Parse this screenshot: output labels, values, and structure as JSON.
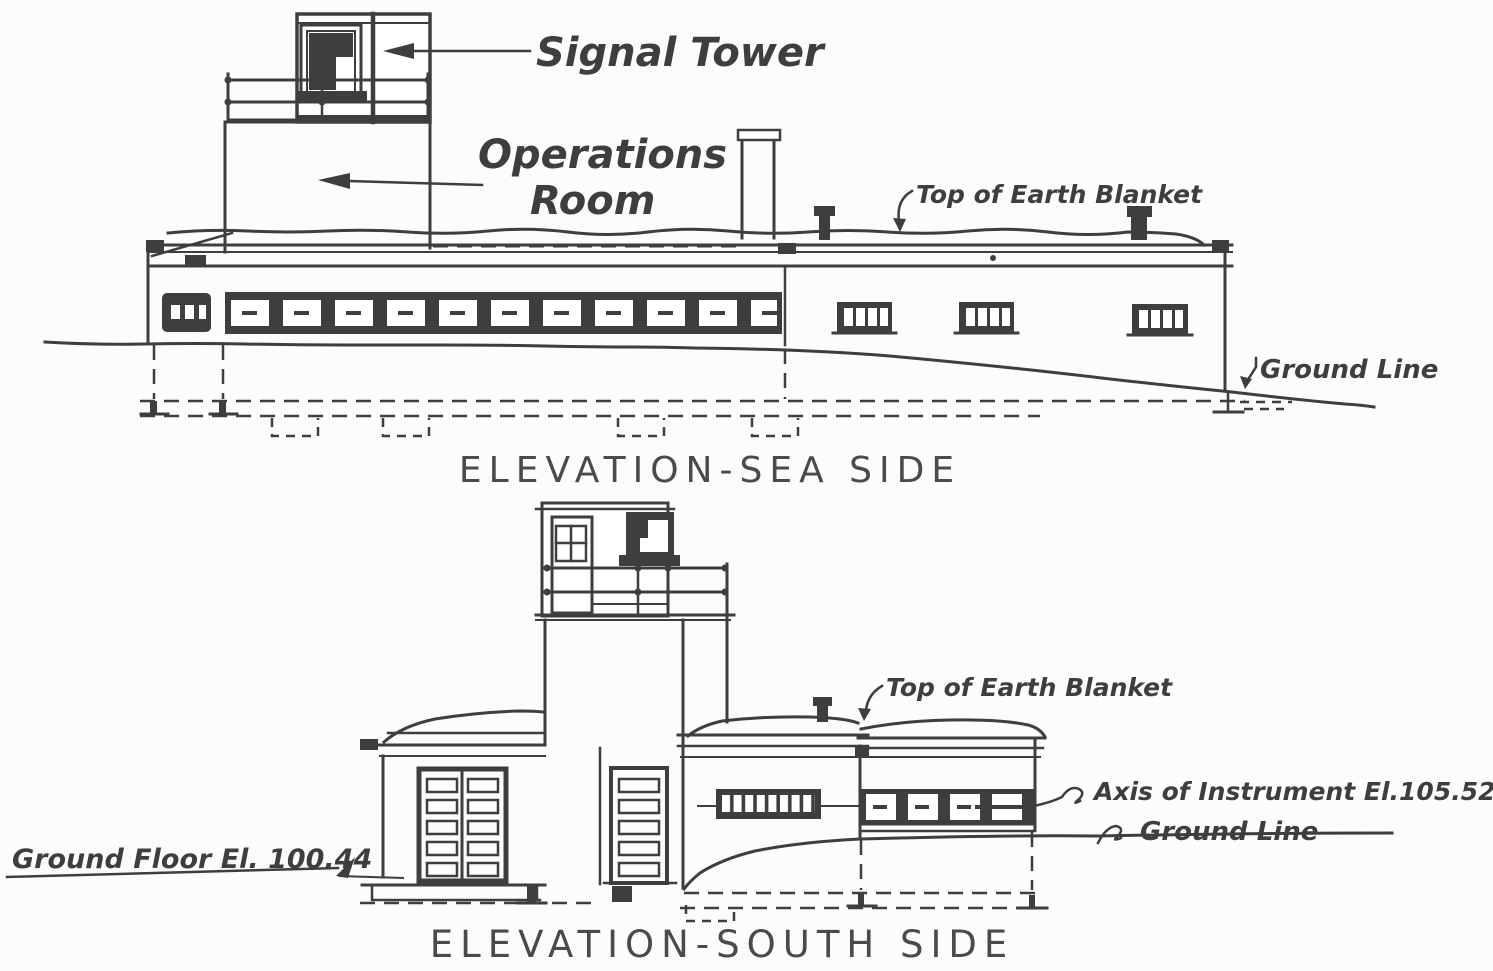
{
  "document": {
    "kind": "architectural elevation drawing",
    "ink_color": "#3e3e3e",
    "paper_color": "#fcfcfc"
  },
  "sea_side": {
    "title": "ELEVATION-SEA SIDE",
    "labels": {
      "signal_tower": "Signal Tower",
      "operations_line1": "Operations",
      "operations_line2": "Room",
      "earth_blanket": "Top of Earth Blanket",
      "ground_line": "Ground Line"
    }
  },
  "south_side": {
    "title": "ELEVATION-SOUTH SIDE",
    "labels": {
      "earth_blanket": "Top of Earth Blanket",
      "axis_instrument": "Axis of Instrument El.105.52",
      "ground_line": "Ground Line",
      "ground_floor": "Ground Floor El. 100.44"
    }
  }
}
